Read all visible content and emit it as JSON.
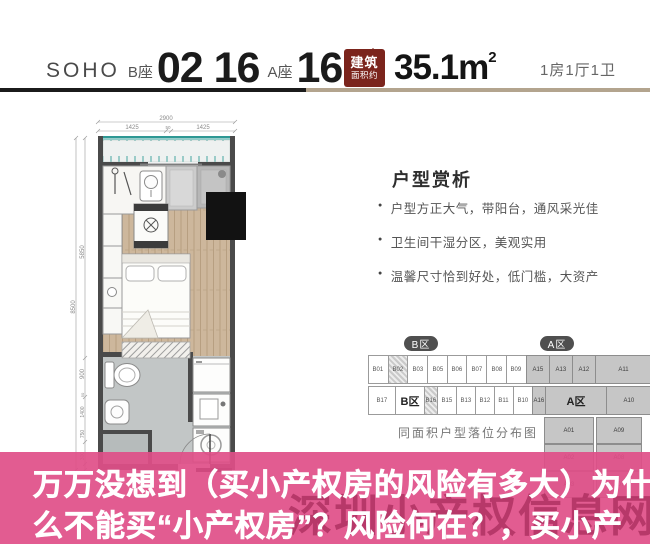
{
  "header": {
    "brand": "SOHO",
    "tower_b_label": "B座",
    "unit_numbers_b": "02 16",
    "tower_a_label": "A座",
    "unit_number_a": "16",
    "unit_suffix": "户型",
    "area_badge": {
      "line1": "建筑",
      "line2": "面积约"
    },
    "area_value": "35.1m",
    "area_sup": "2",
    "layout_summary": "1房1厅1卫"
  },
  "panel": {
    "title": "户型赏析",
    "bullets": [
      "户型方正大气，带阳台，通风采光佳",
      "卫生间干湿分区，美观实用",
      "温馨尺寸恰到好处，低门槛，大资产"
    ]
  },
  "plan": {
    "dims": {
      "top_total": "2900",
      "top_segments": [
        "1425",
        "50",
        "1425"
      ],
      "left_total": "8500",
      "left_segments": [
        "5850",
        "900",
        "1400",
        "50",
        "750",
        "300"
      ],
      "bottom_segments": [
        "200",
        "1150",
        "50",
        "1100",
        "600"
      ]
    }
  },
  "diagram": {
    "pill_b": "B区",
    "pill_a": "A区",
    "caption": "同面积户型落位分布图",
    "row1": [
      {
        "label": "B01",
        "w": 18.7
      },
      {
        "label": "B02",
        "w": 18.7,
        "v": "hatch"
      },
      {
        "label": "B03",
        "w": 18.7
      },
      {
        "label": "B05",
        "w": 18.7
      },
      {
        "label": "B06",
        "w": 18.7
      },
      {
        "label": "B07",
        "w": 18.7
      },
      {
        "label": "B08",
        "w": 18.7
      },
      {
        "label": "B09",
        "w": 18.7
      },
      {
        "label": "A15",
        "w": 22,
        "v": "gray"
      },
      {
        "label": "A13",
        "w": 22,
        "v": "gray"
      },
      {
        "label": "A12",
        "w": 22,
        "v": "gray"
      },
      {
        "label": "A11",
        "w": 56,
        "v": "gray"
      }
    ],
    "row2": [
      {
        "label": "B17",
        "w": 26
      },
      {
        "label": "B区",
        "w": 28,
        "v": "blabel"
      },
      {
        "label": "B16",
        "w": 12,
        "v": "hatch"
      },
      {
        "label": "B15",
        "w": 18
      },
      {
        "label": "B13",
        "w": 18
      },
      {
        "label": "B12",
        "w": 18
      },
      {
        "label": "B11",
        "w": 18
      },
      {
        "label": "B10",
        "w": 18
      },
      {
        "label": "A16",
        "w": 12,
        "v": "gray"
      },
      {
        "label": "A区",
        "w": 60,
        "v": "alabel gray"
      },
      {
        "label": "A10",
        "w": 44,
        "v": "gray"
      }
    ],
    "pairs": [
      {
        "a": "A01",
        "b": "A09"
      },
      {
        "a": "A02",
        "b": "A08"
      },
      {
        "a": "A03",
        "b": "A07"
      }
    ]
  },
  "overlay": {
    "line1": "万万没想到（买小产权房的风险有多大）为什",
    "line2": "么不能买“小产权房”？风险何在？，买小产",
    "watermark": "深圳小产权信息网"
  },
  "colors": {
    "accent_pink": "#df4e88",
    "watermark_pink": "#a92c5c",
    "badge_red": "#7b241c",
    "separator_tan": "#b3a48e",
    "wall_gray": "#4a4a4a",
    "wood_floor": "#cdb79c",
    "balcony_teal": "#2e9894"
  }
}
